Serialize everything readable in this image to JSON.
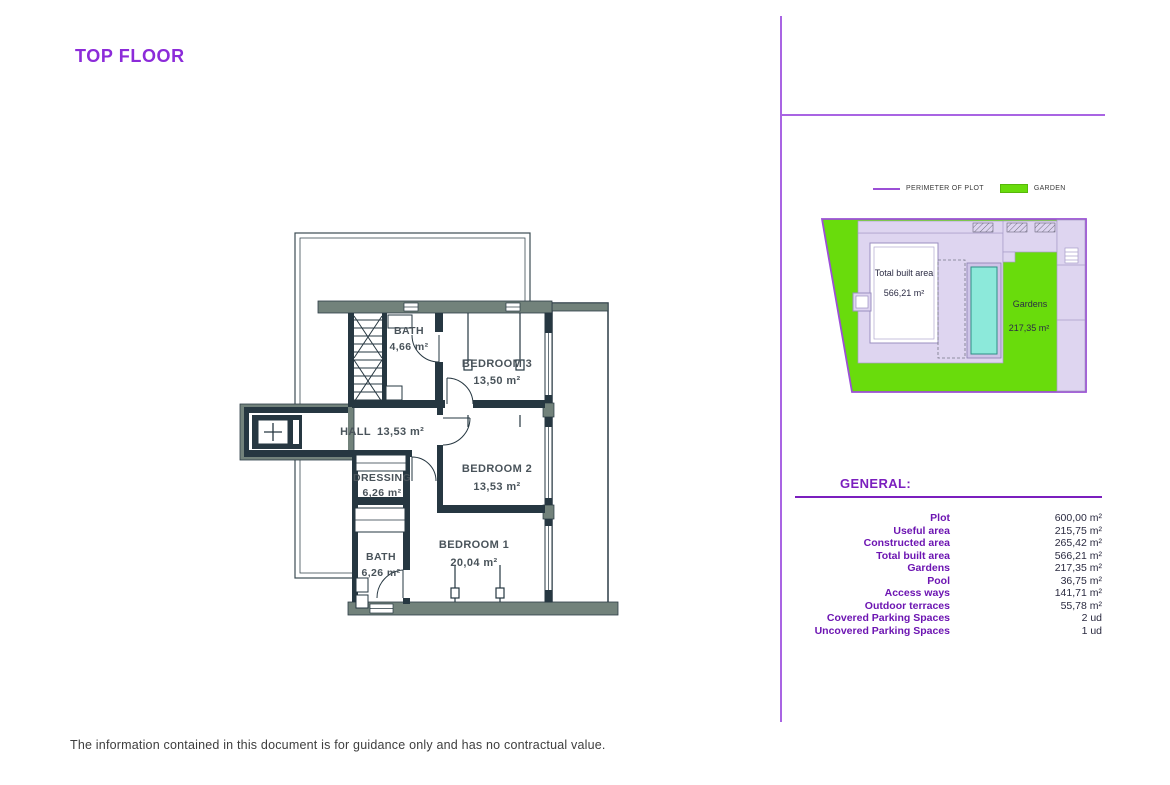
{
  "page": {
    "title": "TOP FLOOR",
    "footer": "The information contained in this document is for guidance only and has no contractual value."
  },
  "floor_plan": {
    "rooms": [
      {
        "name": "BATH",
        "area": "4,66 m²"
      },
      {
        "name": "BEDROOM 3",
        "area": "13,50 m²"
      },
      {
        "name": "HALL",
        "area": "13,53 m²"
      },
      {
        "name": "DRESSING",
        "area": "6,26 m²"
      },
      {
        "name": "BEDROOM 2",
        "area": "13,53 m²"
      },
      {
        "name": "BATH",
        "area": "6,26 m²"
      },
      {
        "name": "BEDROOM 1",
        "area": "20,04 m²"
      }
    ]
  },
  "site_plan": {
    "legend": [
      {
        "label": "PERIMETER OF PLOT",
        "swatch": "line",
        "color": "#9b4fd6"
      },
      {
        "label": "GARDEN",
        "swatch": "rect",
        "color": "#69dc0c"
      }
    ],
    "labels": {
      "built_area_line1": "Total built area",
      "built_area_line2": "566,21 m²",
      "gardens_line1": "Gardens",
      "gardens_line2": "217,35 m²"
    },
    "colors": {
      "garden_green": "#69dc0c",
      "perimeter_purple": "#9b4fd6",
      "hardscape_lavender": "#ded5f0",
      "pool_cyan": "#8ce9da"
    }
  },
  "general": {
    "heading": "GENERAL:",
    "rows": [
      {
        "label": "Plot",
        "value": "600,00 m²"
      },
      {
        "label": "Useful area",
        "value": "215,75 m²"
      },
      {
        "label": "Constructed area",
        "value": "265,42 m²"
      },
      {
        "label": "Total built area",
        "value": "566,21 m²"
      },
      {
        "label": "Gardens",
        "value": "217,35 m²"
      },
      {
        "label": "Pool",
        "value": "36,75 m²"
      },
      {
        "label": "Access ways",
        "value": "141,71 m²"
      },
      {
        "label": "Outdoor terraces",
        "value": "55,78 m²"
      },
      {
        "label": "Covered Parking Spaces",
        "value": "2 ud"
      },
      {
        "label": "Uncovered Parking Spaces",
        "value": "1 ud"
      }
    ]
  }
}
